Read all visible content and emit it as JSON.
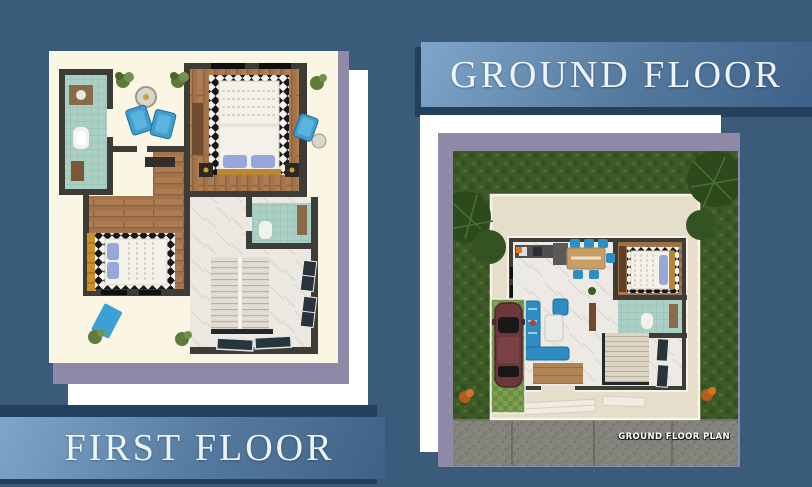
{
  "poster": {
    "background_color": "#3b5b7a",
    "banners": {
      "ground_floor": {
        "label": "GROUND FLOOR"
      },
      "first_floor": {
        "label": "FIRST FLOOR"
      }
    },
    "plans": {
      "ground": {
        "caption": "GROUND FLOOR PLAN"
      }
    },
    "colors": {
      "bg": "#3b5b7a",
      "navy_shadow": "#24405d",
      "slate_card": "#8d89a6",
      "cream_card": "#fbf5e4",
      "white_card": "#ffffff",
      "banner_light": "#7fa6ca",
      "banner_mid": "#54799e",
      "banner_dark": "#3f6189",
      "banner_text": "#eef4f9"
    }
  }
}
